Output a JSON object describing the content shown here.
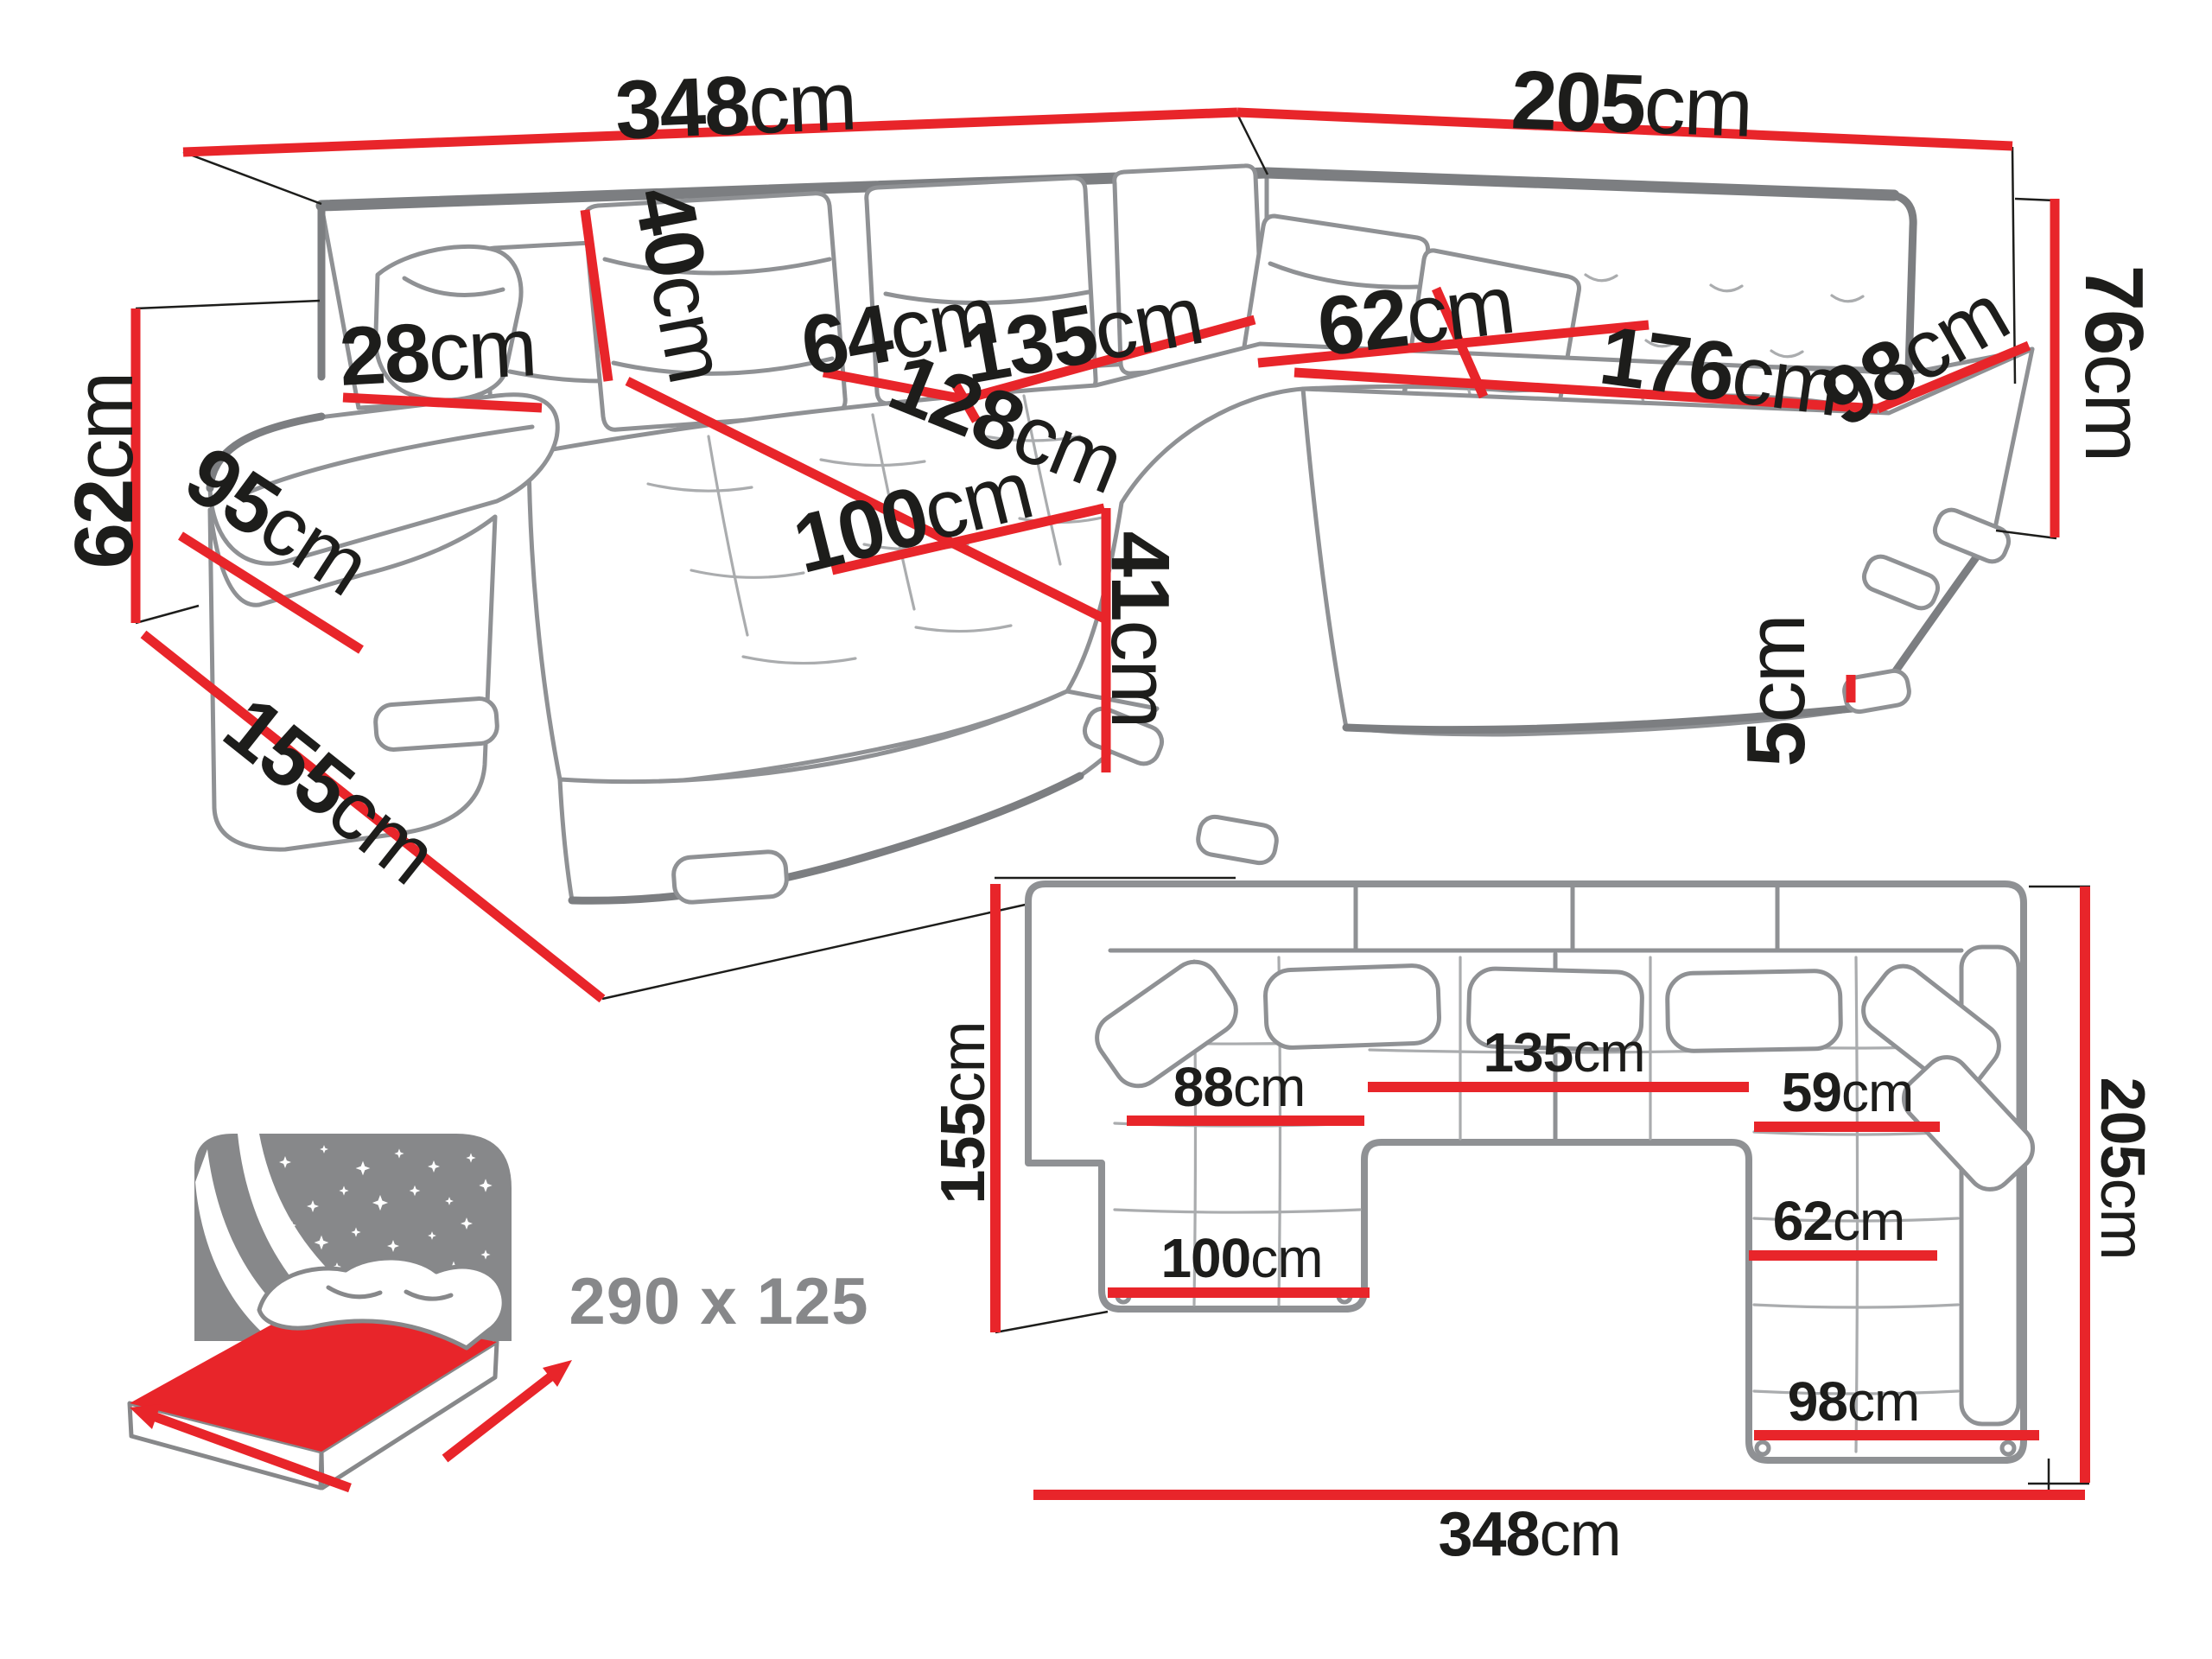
{
  "colors": {
    "dimension_red": "#e8252a",
    "sketch_gray": "#8f9194",
    "sketch_dark_gray": "#7c7e81",
    "tuft_gray": "#aaacae",
    "label_black": "#1d1d1b",
    "icon_gray": "#87888a"
  },
  "perspective_view": {
    "dimensions": {
      "total_width_left": {
        "value": "348",
        "unit": "cm"
      },
      "total_width_right": {
        "value": "205",
        "unit": "cm"
      },
      "back_height": {
        "value": "76",
        "unit": "cm"
      },
      "arm_height": {
        "value": "62",
        "unit": "cm"
      },
      "arm_front_length": {
        "value": "95",
        "unit": "cm"
      },
      "chaise_depth": {
        "value": "155",
        "unit": "cm"
      },
      "armrest_width": {
        "value": "28",
        "unit": "cm"
      },
      "back_cushion_height": {
        "value": "40",
        "unit": "cm"
      },
      "corner_seat_back": {
        "value": "64",
        "unit": "cm"
      },
      "middle_seat_width": {
        "value": "135",
        "unit": "cm"
      },
      "chaise_length": {
        "value": "128",
        "unit": "cm"
      },
      "chaise_width": {
        "value": "100",
        "unit": "cm"
      },
      "seat_height": {
        "value": "41",
        "unit": "cm"
      },
      "corner_seat_depth": {
        "value": "62",
        "unit": "cm"
      },
      "right_seat_length": {
        "value": "176",
        "unit": "cm"
      },
      "right_seat_depth": {
        "value": "98",
        "unit": "cm"
      },
      "leg_height": {
        "value": "5",
        "unit": "cm"
      }
    }
  },
  "plan_view": {
    "dimensions": {
      "left_depth": {
        "value": "155",
        "unit": "cm"
      },
      "chaise_seat_width": {
        "value": "88",
        "unit": "cm"
      },
      "middle_seat_width": {
        "value": "135",
        "unit": "cm"
      },
      "right_seat_top_width": {
        "value": "59",
        "unit": "cm"
      },
      "right_seat_width": {
        "value": "62",
        "unit": "cm"
      },
      "chaise_outer_width": {
        "value": "100",
        "unit": "cm"
      },
      "right_outer_width": {
        "value": "98",
        "unit": "cm"
      },
      "right_depth": {
        "value": "205",
        "unit": "cm"
      },
      "total_width": {
        "value": "348",
        "unit": "cm"
      }
    }
  },
  "sleeping_area": {
    "size_label": "290 x 125"
  }
}
